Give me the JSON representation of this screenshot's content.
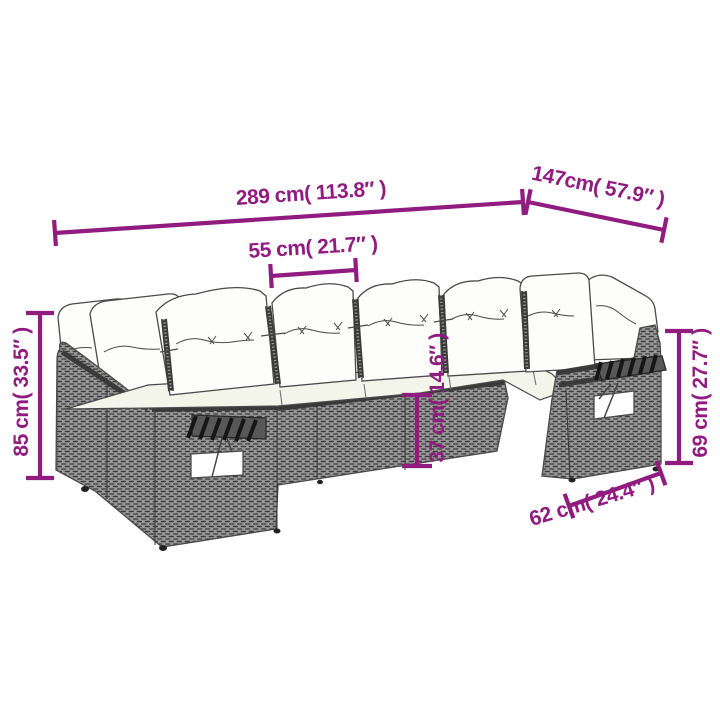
{
  "colors": {
    "accent": "#911c80",
    "outline_gray": "#4a4a4a",
    "cushion_white": "#fdfdfc",
    "seat_cream": "#f3f4ea"
  },
  "dimensions": {
    "total_width": "289 cm( 113.8″ )",
    "total_depth": "147cm( 57.9″ )",
    "seat_width": "55 cm( 21.7″ )",
    "total_height": "85 cm( 33.5″ )",
    "seat_height": "37 cm( 14.6″ )",
    "arm_back_height": "69 cm( 27.7″ )",
    "module_depth": "62 cm( 24.4″ )"
  }
}
